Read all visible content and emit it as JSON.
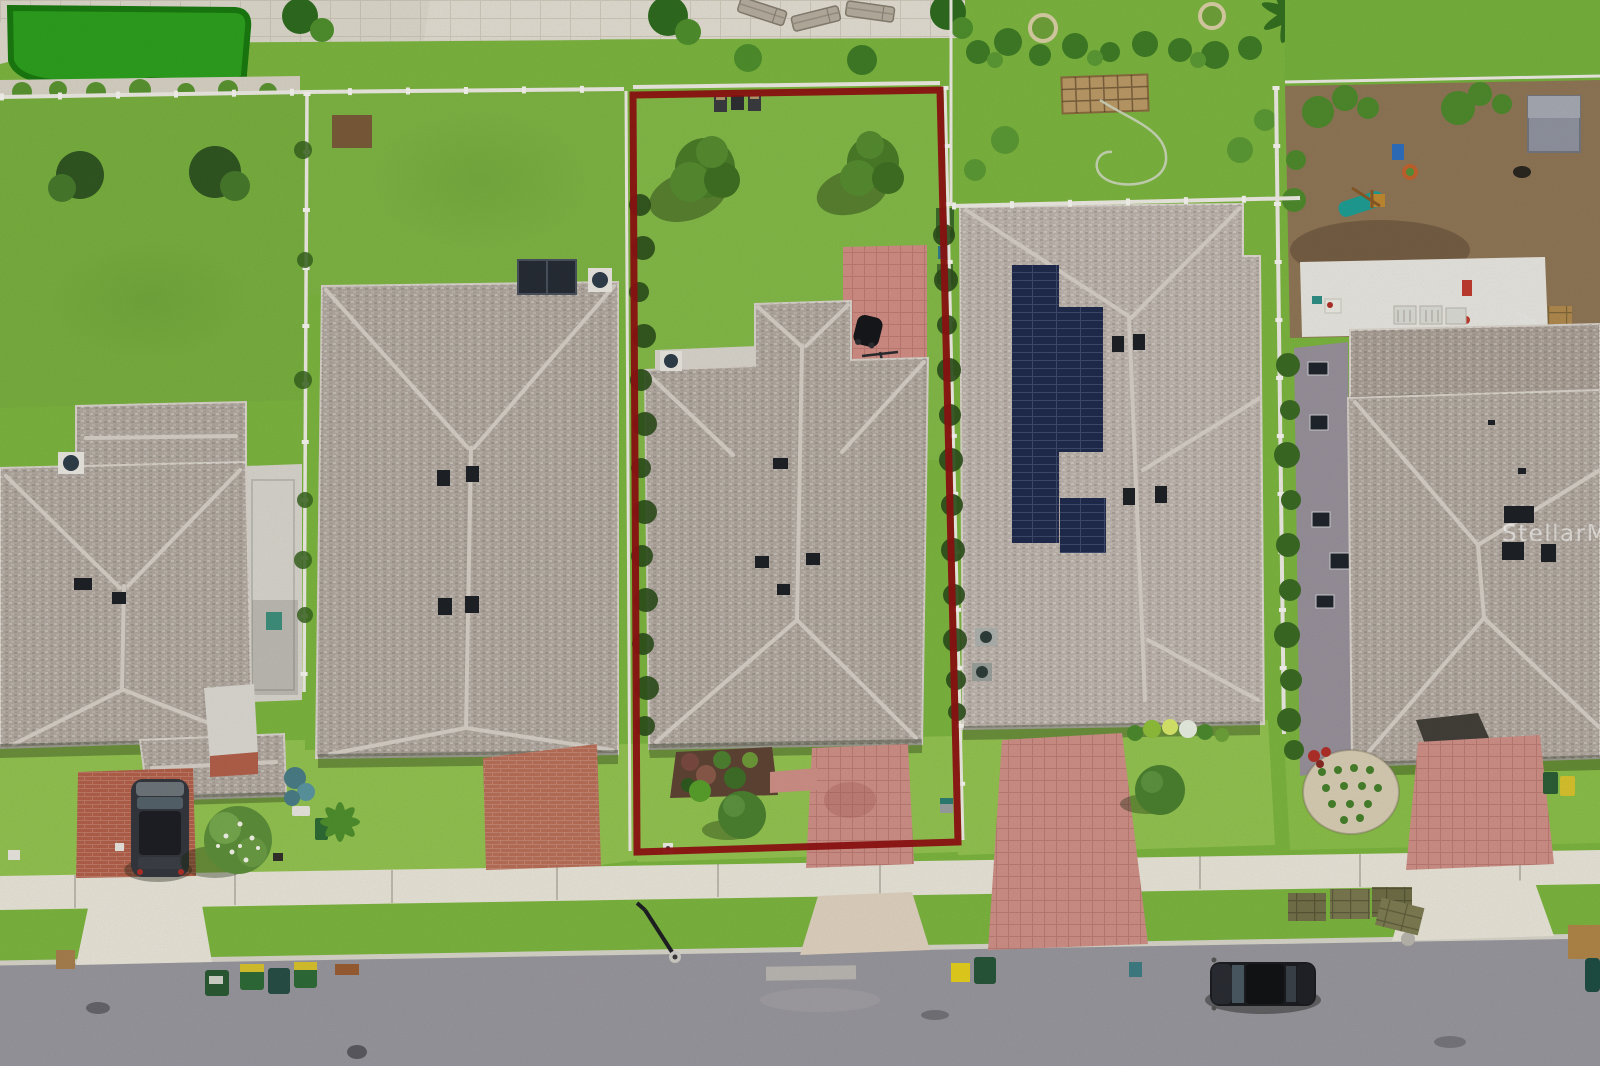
{
  "photo": {
    "watermark": "StellarMLS"
  },
  "colors": {
    "grass": "#7cb53f",
    "grass_bright": "#8abf49",
    "grass_front": "#93c351",
    "putting_green": "#2da01e",
    "roof_gray": "#b2a9a0",
    "roof_light": "#bdb4ac",
    "ridge": "#d6cfc7",
    "street": "#98979d",
    "concrete": "#e9e5d9",
    "paver_pink": "#cf9087",
    "brick_red": "#b2604a",
    "solar_navy": "#202b4d",
    "dirt": "#8f7656",
    "hedge": "#2c4e1b",
    "fence_white": "#edebe3",
    "boundary_red": "#8e1212"
  }
}
